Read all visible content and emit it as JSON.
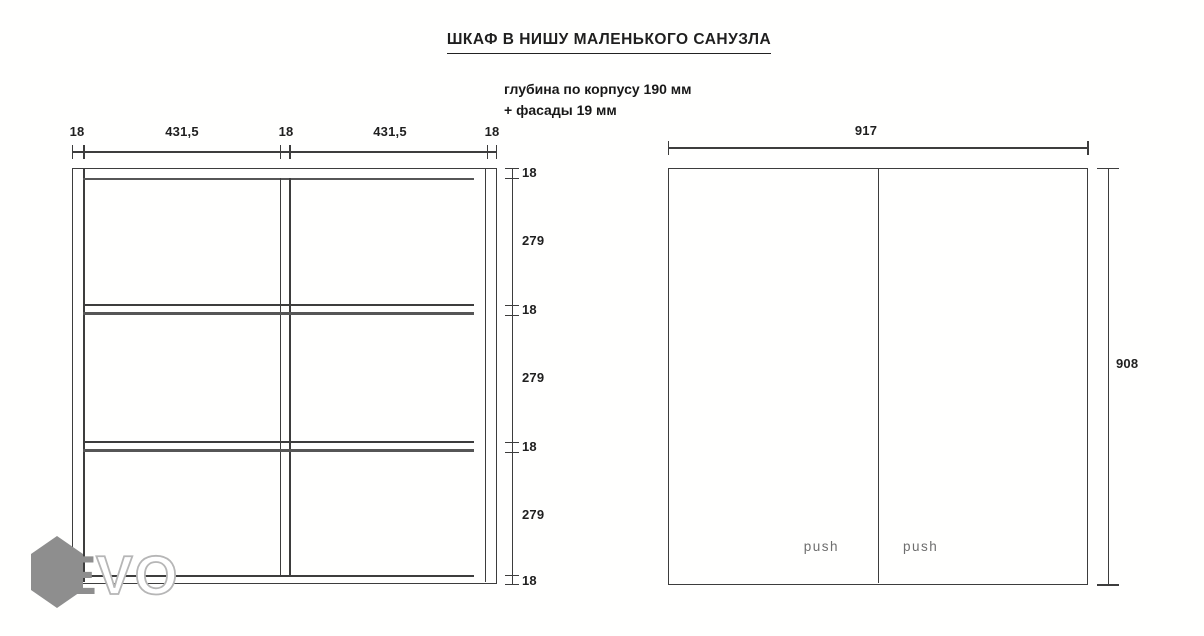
{
  "title": "ШКАФ В НИШУ МАЛЕНЬКОГО САНУЗЛА",
  "notes": {
    "line1": "глубина по корпусу 190 мм",
    "line2": "+ фасады 19 мм"
  },
  "section_view": {
    "top_dims": [
      "18",
      "431,5",
      "18",
      "431,5",
      "18"
    ],
    "side_dims": [
      "18",
      "279",
      "18",
      "279",
      "18",
      "279",
      "18"
    ]
  },
  "front_view": {
    "width_dim": "917",
    "height_dim": "908",
    "push_left": "push",
    "push_right": "push"
  },
  "logo": {
    "text": "EVO",
    "letter_e": "E",
    "letters_vo": "VO"
  },
  "colors": {
    "line": "#3d3d3d",
    "thick": "#565656",
    "text": "#1f1f1f",
    "push": "#6e6e6e",
    "logo_gray": "#8e8e8e",
    "logo_outline": "#b6b6b6",
    "bg": "#fffffe"
  }
}
